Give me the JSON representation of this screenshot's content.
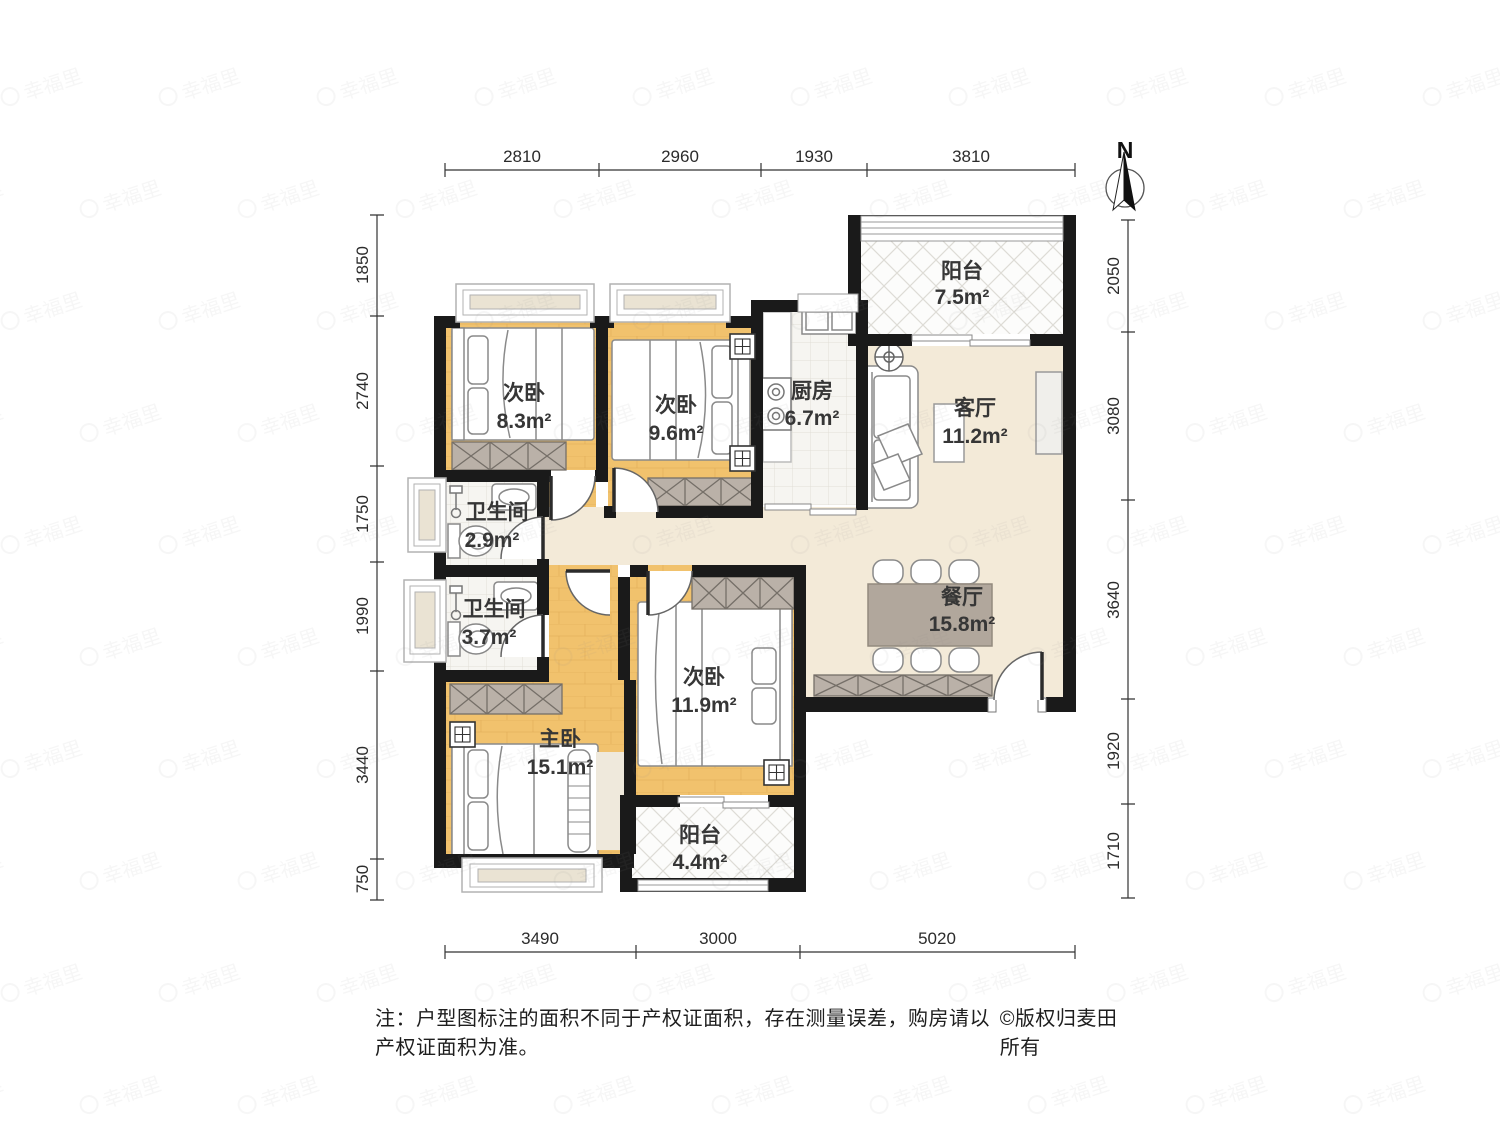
{
  "watermark": {
    "text": "幸福里"
  },
  "north_label": "N",
  "dimensions": {
    "top": [
      "2810",
      "2960",
      "1930",
      "3810"
    ],
    "left": [
      "1850",
      "2740",
      "1750",
      "1990",
      "3440",
      "750"
    ],
    "right": [
      "2050",
      "3080",
      "3640",
      "1920",
      "1710"
    ],
    "bottom": [
      "3490",
      "3000",
      "5020"
    ]
  },
  "rooms": {
    "balcony_top": {
      "name": "阳台",
      "area": "7.5m²"
    },
    "bedroom_83": {
      "name": "次卧",
      "area": "8.3m²"
    },
    "bedroom_96": {
      "name": "次卧",
      "area": "9.6m²"
    },
    "kitchen": {
      "name": "厨房",
      "area": "6.7m²"
    },
    "living": {
      "name": "客厅",
      "area": "11.2m²"
    },
    "bath_29": {
      "name": "卫生间",
      "area": "2.9m²"
    },
    "bath_37": {
      "name": "卫生间",
      "area": "3.7m²"
    },
    "dining": {
      "name": "餐厅",
      "area": "15.8m²"
    },
    "bedroom_119": {
      "name": "次卧",
      "area": "11.9m²"
    },
    "master": {
      "name": "主卧",
      "area": "15.1m²"
    },
    "balcony_bottom": {
      "name": "阳台",
      "area": "4.4m²"
    }
  },
  "footer": {
    "note": "注：户型图标注的面积不同于产权证面积，存在测量误差，购房请以产权证面积为准。",
    "copyright": "©版权归麦田所有"
  }
}
